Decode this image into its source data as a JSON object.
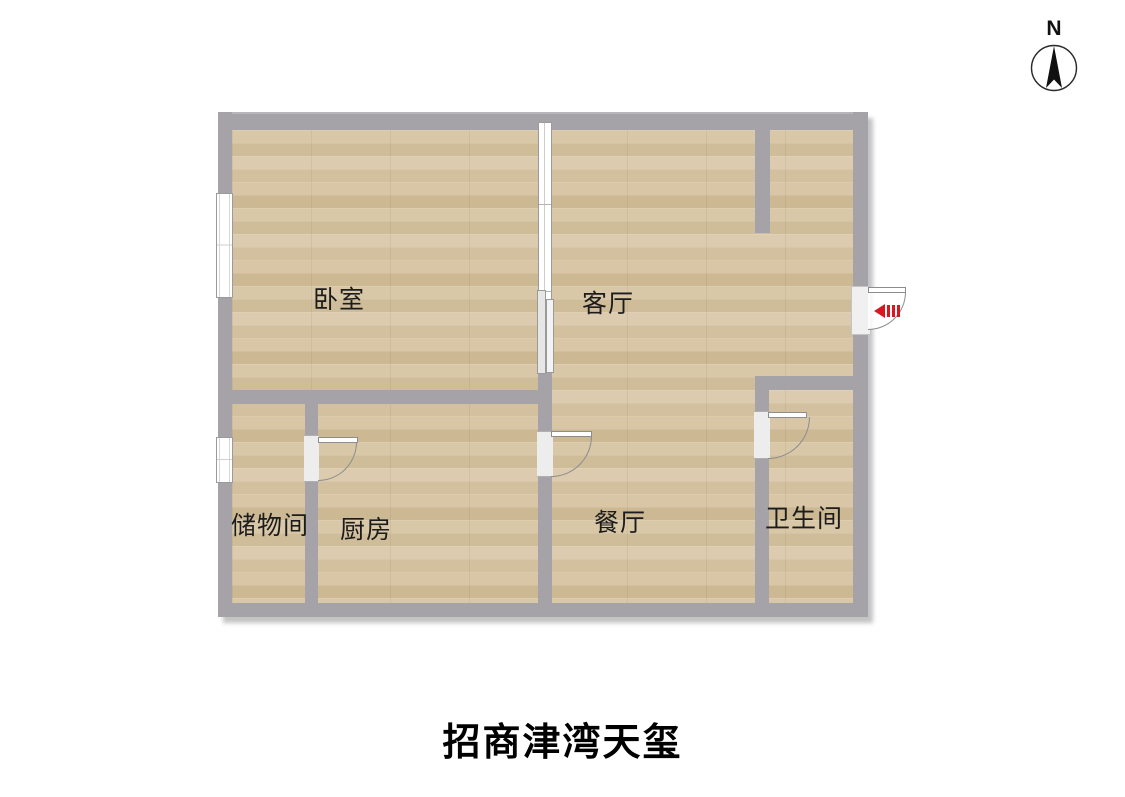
{
  "title": "招商津湾天玺",
  "compass": {
    "label": "N"
  },
  "rooms": {
    "bedroom": {
      "label": "卧室"
    },
    "living": {
      "label": "客厅"
    },
    "storage": {
      "label": "储物间"
    },
    "kitchen": {
      "label": "厨房"
    },
    "dining": {
      "label": "餐厅"
    },
    "bathroom": {
      "label": "卫生间"
    }
  },
  "features": {
    "entrance_marker": "entry-arrow",
    "windows": [
      "bedroom-left-window",
      "storage-left-window"
    ],
    "doors": [
      "storage-kitchen-door",
      "kitchen-dining-door",
      "bathroom-door",
      "entrance-door"
    ],
    "partition": "bedroom-living-sliding-glass-door"
  },
  "colors": {
    "wall": "#a5a2a8",
    "floor": "#d6c4a2",
    "entry": "#d51920",
    "bg": "#ffffff"
  }
}
